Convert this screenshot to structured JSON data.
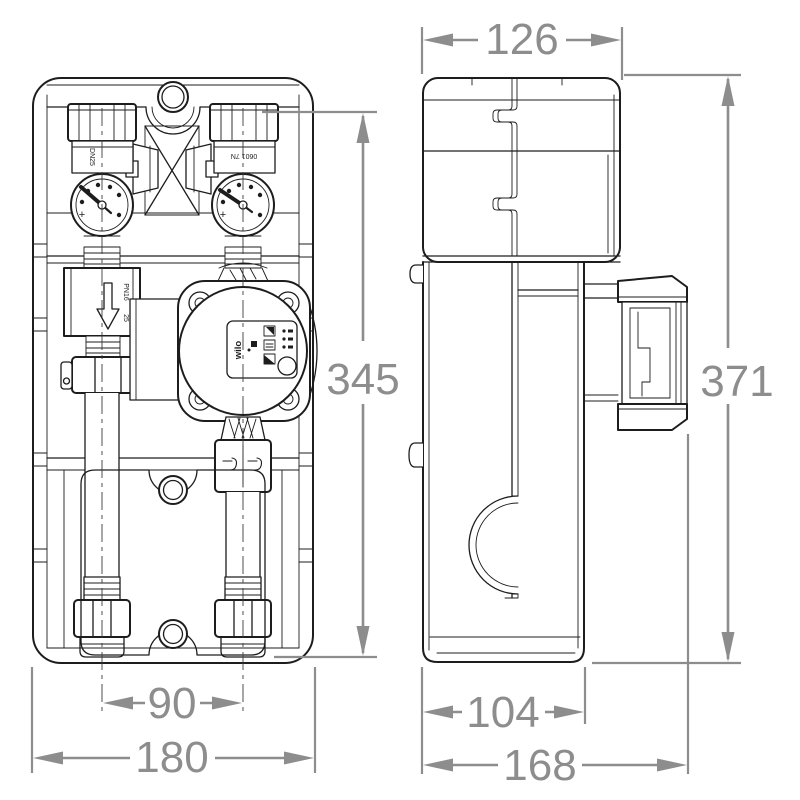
{
  "drawing": {
    "dimensions": {
      "side_width": "126",
      "side_height": "371",
      "front_height": "345",
      "pipe_spacing": "90",
      "front_width": "180",
      "side_depth_lower": "104",
      "side_depth_total": "168"
    },
    "labels": {
      "pump_brand": "wilo",
      "left_valve": "DN25",
      "check_valve_pressure": "PN16",
      "check_valve_size": "25",
      "right_valve": "0601 7N",
      "gauge_mark": "+"
    },
    "colors": {
      "line": "#1d1d1d",
      "dimension": "#8d8d8d",
      "background": "#ffffff"
    }
  }
}
